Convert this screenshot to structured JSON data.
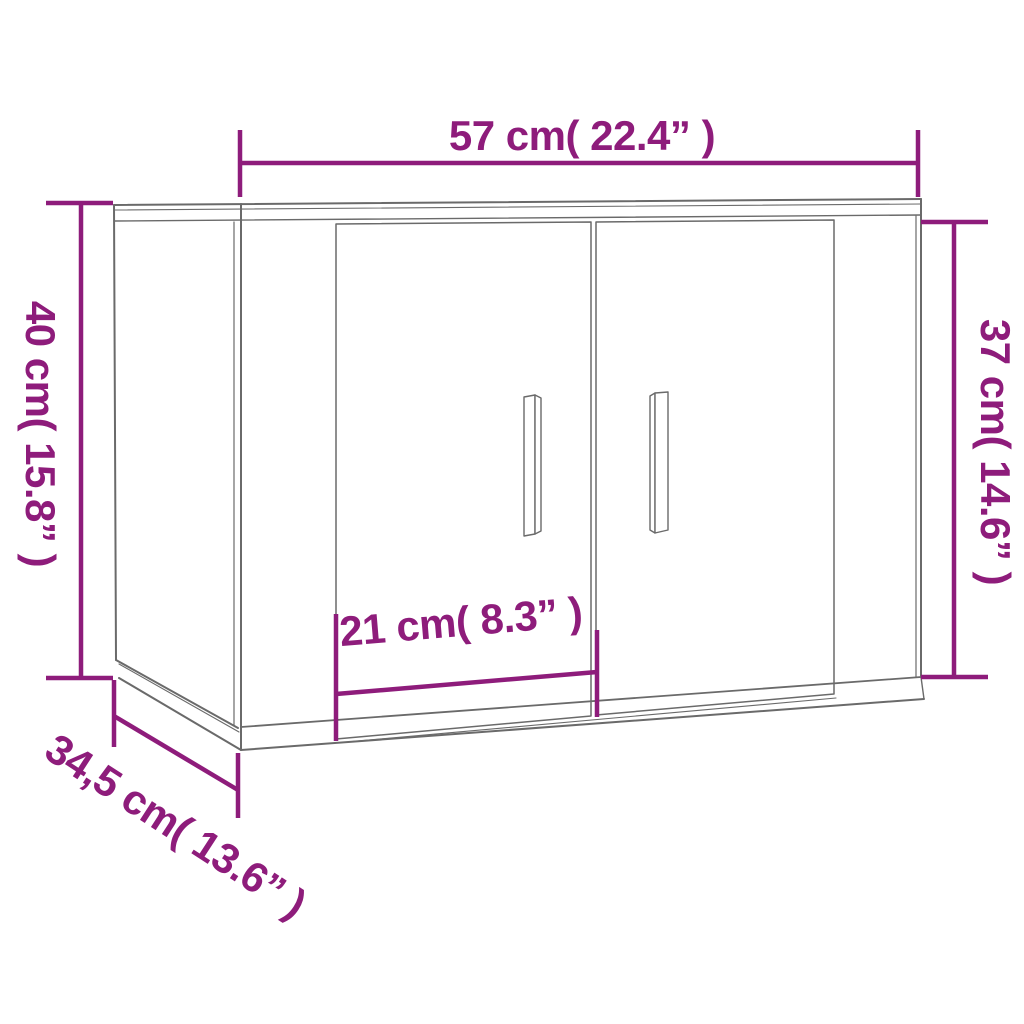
{
  "colors": {
    "accent": "#8E1C7B",
    "line": "#6A6A6A",
    "background": "#FFFFFF"
  },
  "dimensions": {
    "width": {
      "label": "57 cm( 22.4” )",
      "cm": "57",
      "inch": "22.4"
    },
    "height_left": {
      "label": "40 cm( 15.8” )",
      "cm": "40",
      "inch": "15.8"
    },
    "height_right": {
      "label": "37 cm( 14.6” )",
      "cm": "37",
      "inch": "14.6"
    },
    "door_width": {
      "label": "21 cm( 8.3” )",
      "cm": "21",
      "inch": "8.3"
    },
    "depth": {
      "label": "34,5 cm( 13.6” )",
      "cm": "34,5",
      "inch": "13.6"
    }
  }
}
